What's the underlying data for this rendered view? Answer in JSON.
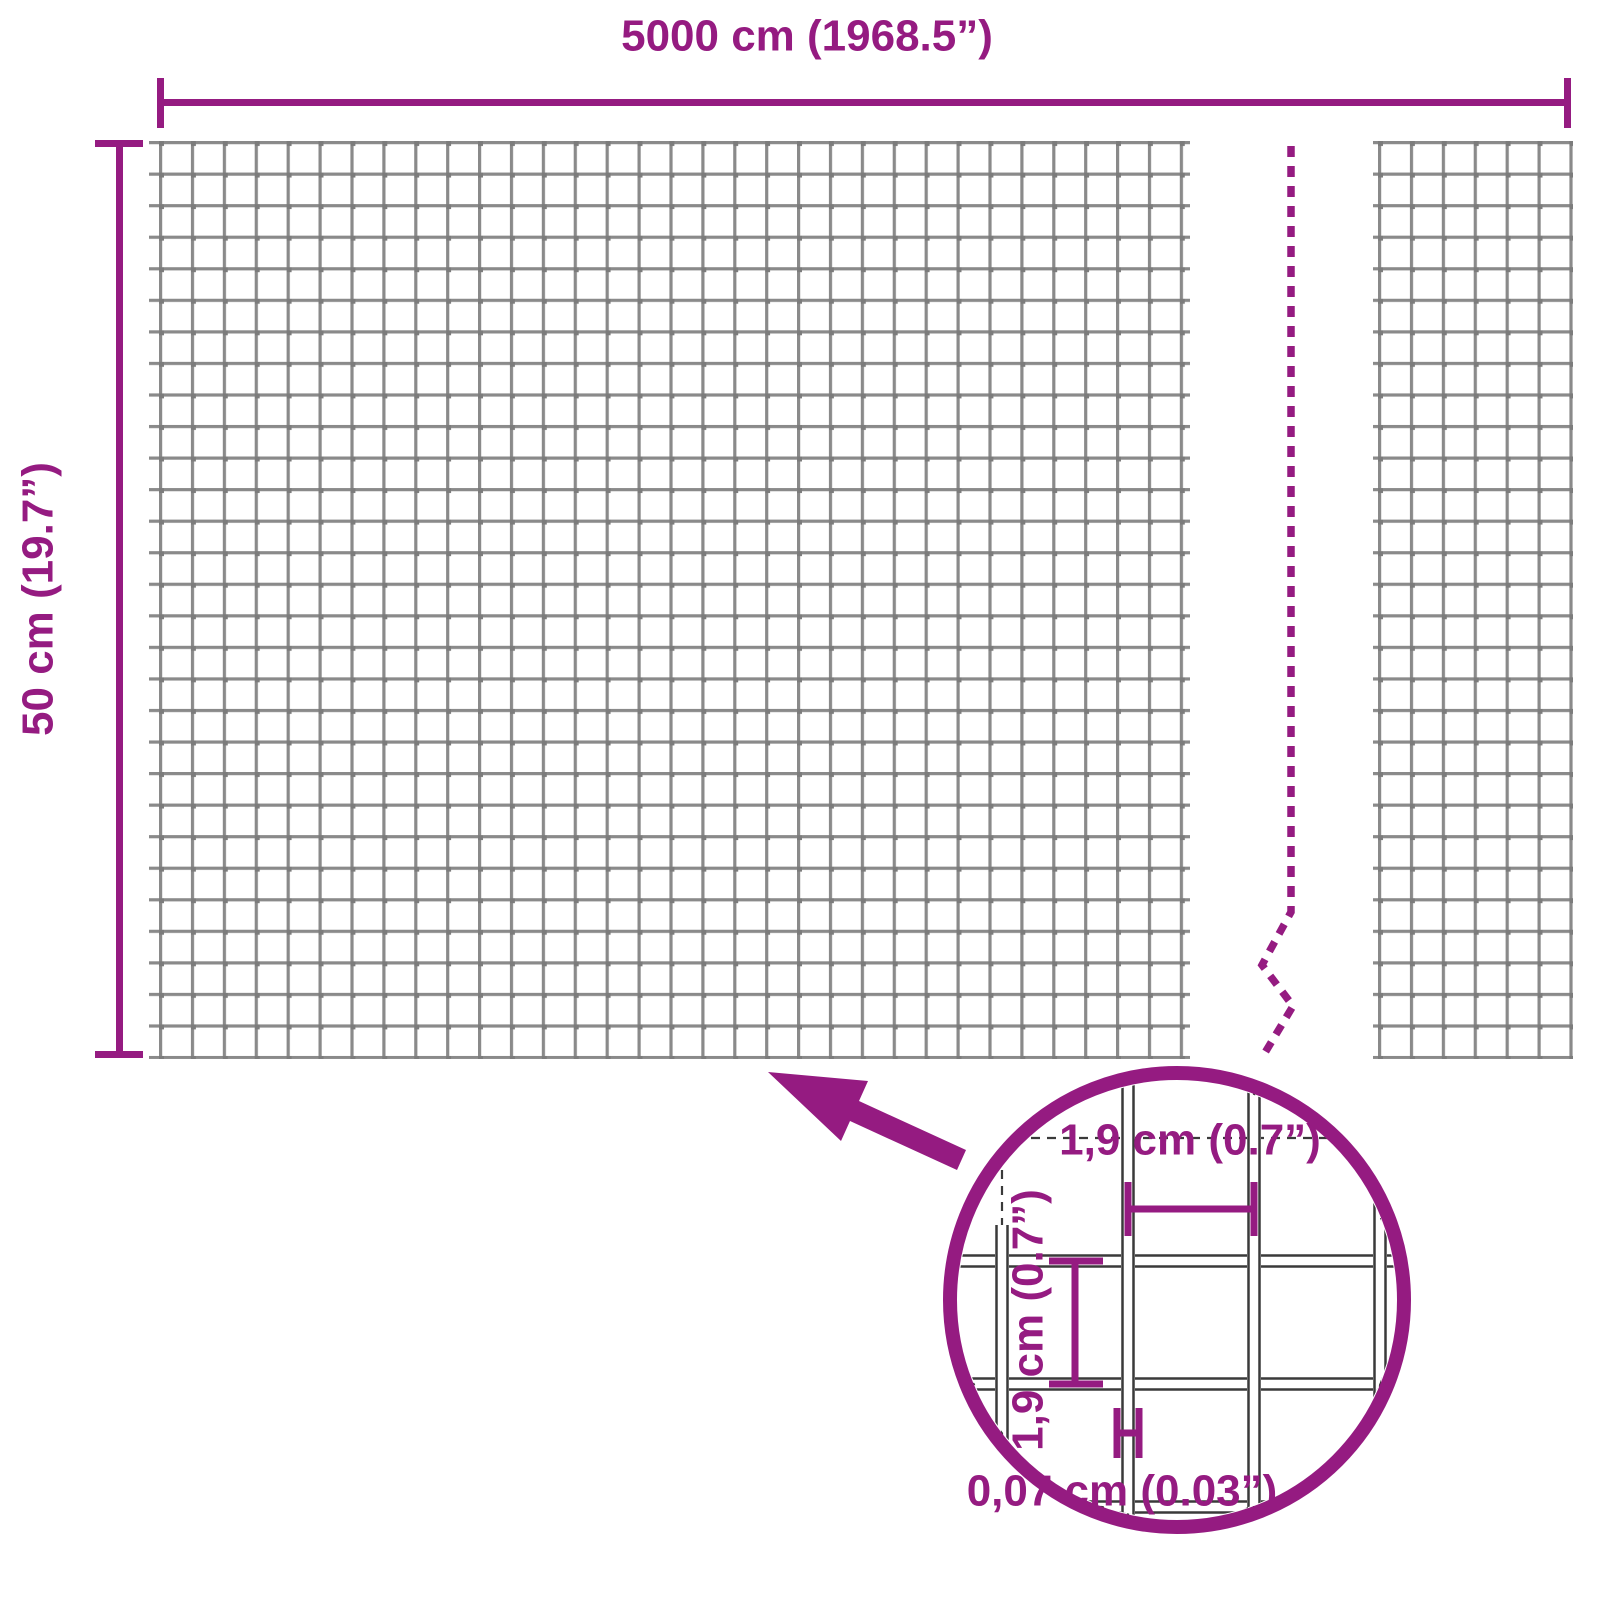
{
  "diagram": {
    "title": "wire-mesh-dimension-diagram",
    "colors": {
      "accent": "#951b81",
      "mesh_grid": "#8a8a8a",
      "detail_wire": "#3a3a3a",
      "background": "#ffffff"
    },
    "dimensions": {
      "width_label": "5000 cm (1968.5”)",
      "height_label": "50 cm (19.7”)"
    },
    "detail": {
      "mesh_width_label": "1,9 cm (0.7”)",
      "mesh_height_label": "1,9 cm (0.7”)",
      "wire_thickness_label": "0,07 cm (0.03”)"
    }
  }
}
